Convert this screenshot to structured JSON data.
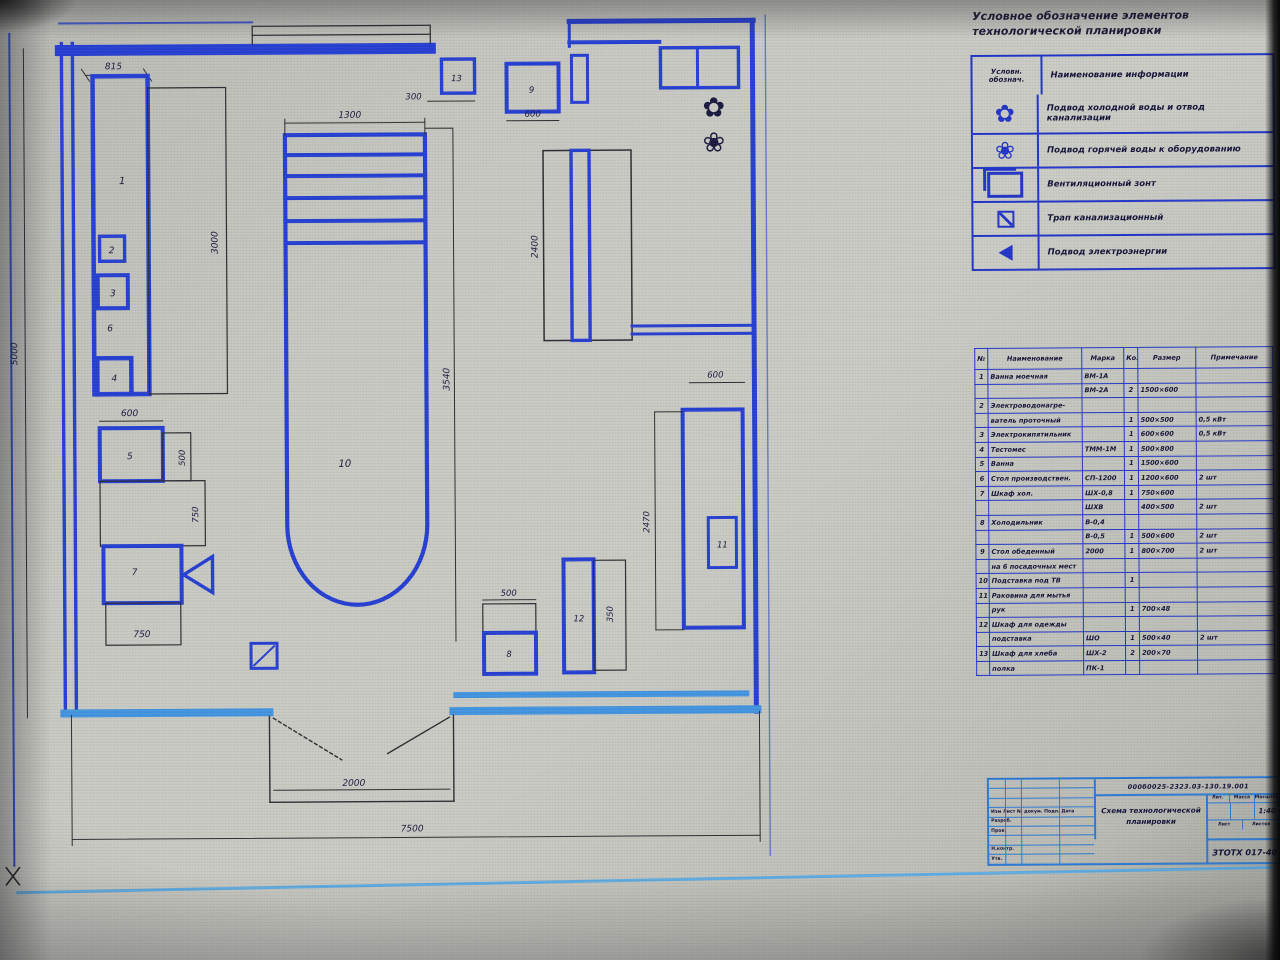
{
  "legend": {
    "title": "Условное обозначение элементов технологической планировки",
    "col_symbol": "Условн. обознач.",
    "col_desc": "Наименование информации",
    "rows": [
      {
        "icon": "cold-water-symbol",
        "desc": "Подвод холодной воды и отвод канализации"
      },
      {
        "icon": "hot-water-symbol",
        "desc": "Подвод горячей воды к оборудованию"
      },
      {
        "icon": "vent-hood-symbol",
        "desc": "Вентиляционный зонт"
      },
      {
        "icon": "drain-symbol",
        "desc": "Трап канализационный"
      },
      {
        "icon": "power-symbol",
        "desc": "Подвод электроэнергии"
      }
    ]
  },
  "spec_table": {
    "headers": [
      "№",
      "Наименование",
      "Марка",
      "Кол",
      "Размер",
      "Примечание"
    ],
    "rows": [
      [
        "1",
        "Ванна моечная",
        "ВМ-1А",
        "",
        "",
        ""
      ],
      [
        "",
        "",
        "ВМ-2А",
        "2",
        "1500×600",
        ""
      ],
      [
        "2",
        "Электроводонагре-",
        "",
        "",
        "",
        ""
      ],
      [
        "",
        "ватель проточный",
        "",
        "1",
        "500×500",
        "0,5 кВт"
      ],
      [
        "3",
        "Электрокипятильник",
        "",
        "1",
        "600×600",
        "0,5 кВт"
      ],
      [
        "4",
        "Тестомес",
        "ТММ-1М",
        "1",
        "500×800",
        ""
      ],
      [
        "5",
        "Ванна",
        "",
        "1",
        "1500×600",
        ""
      ],
      [
        "6",
        "Стол производствен.",
        "СП-1200",
        "1",
        "1200×600",
        "2 шт"
      ],
      [
        "7",
        "Шкаф хол.",
        "ШХ-0,8",
        "1",
        "750×600",
        ""
      ],
      [
        "",
        "",
        "ШХВ",
        "",
        "400×500",
        "2 шт"
      ],
      [
        "8",
        "Холодильник",
        "В-0,4",
        "",
        "",
        ""
      ],
      [
        "",
        "",
        "В-0,5",
        "1",
        "500×600",
        "2 шт"
      ],
      [
        "9",
        "Стол обеденный",
        "2000",
        "1",
        "800×700",
        "2 шт"
      ],
      [
        "",
        "на 6 посадочных мест",
        "",
        "",
        "",
        ""
      ],
      [
        "10",
        "Подставка под ТВ",
        "",
        "1",
        "",
        ""
      ],
      [
        "11",
        "Раковина для мытья",
        "",
        "",
        "",
        ""
      ],
      [
        "",
        "рук",
        "",
        "1",
        "700×48",
        ""
      ],
      [
        "12",
        "Шкаф для одежды",
        "",
        "",
        "",
        ""
      ],
      [
        "",
        "подставка",
        "ШО",
        "1",
        "500×40",
        "2 шт"
      ],
      [
        "13",
        "Шкаф для хлеба",
        "ШХ-2",
        "2",
        "200×70",
        ""
      ],
      [
        "",
        "полка",
        "ПК-1",
        "",
        "",
        ""
      ]
    ]
  },
  "title_block": {
    "doc_number": "000б0025-2323.03-130.19.001",
    "title_line1": "Схема технологической",
    "title_line2": "планировки",
    "left_rows": [
      "",
      "",
      "",
      "Изм Лист № докум. Подп. Дата",
      "Разраб.",
      "Пров.",
      "",
      "Н.контр.",
      "Утв."
    ],
    "lit_label": "Лит.",
    "mass_label": "Масса",
    "scale_label": "Масштаб",
    "scale_value": "1:40",
    "sheet_label": "Лист",
    "sheets_label": "Листов",
    "group": "ЗТОТХ 017-40"
  },
  "plan": {
    "dims": {
      "left_height": "5000",
      "top_left": "815",
      "left_rect_side": "3000",
      "rack_top": "1300",
      "rack_side": "3540",
      "mid_rect_side": "2400",
      "sq13": "300",
      "sq9": "600",
      "c5_top": "600",
      "c5_side": "500",
      "c_mid_side": "750",
      "c7_bottom": "750",
      "b8_top": "500",
      "b12_side": "350",
      "counter_top": "600",
      "counter_side": "2470",
      "door": "2000",
      "overall": "7500"
    },
    "labels": {
      "e1": "1",
      "e2": "2",
      "e3": "3",
      "e4": "4",
      "e5": "5",
      "e6": "6",
      "e7": "7",
      "e8": "8",
      "e9": "9",
      "e10": "10",
      "e11": "11",
      "e12": "12",
      "e13": "13"
    }
  }
}
